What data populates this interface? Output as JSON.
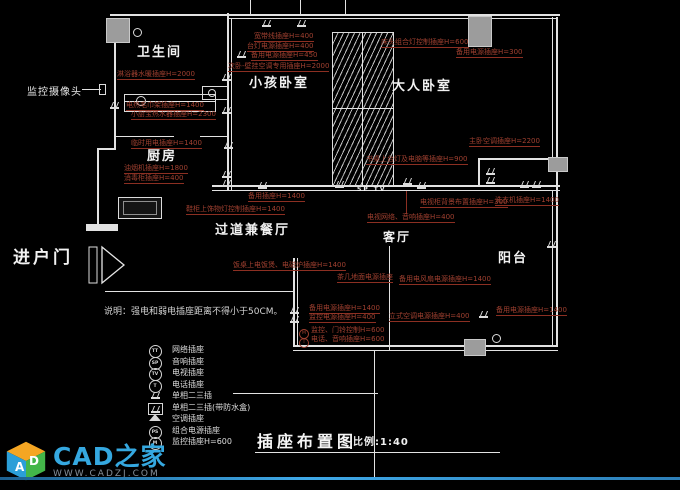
{
  "colors": {
    "background": "#000000",
    "wall": "#e2e2e2",
    "annotation": "#a04030",
    "column_fill": "#9c9c9c",
    "logo_blue": "#35a8e0",
    "footer_line": "#2d7fb8"
  },
  "rooms": [
    {
      "label": "卫生间",
      "x": 137,
      "y": 46,
      "fs": 13
    },
    {
      "label": "厨房",
      "x": 147,
      "y": 150,
      "fs": 13
    },
    {
      "label": "小孩卧室",
      "x": 249,
      "y": 77,
      "fs": 13
    },
    {
      "label": "大人卧室",
      "x": 392,
      "y": 80,
      "fs": 13
    },
    {
      "label": "过道兼餐厅",
      "x": 215,
      "y": 224,
      "fs": 13
    },
    {
      "label": "客厅",
      "x": 383,
      "y": 231,
      "fs": 12
    },
    {
      "label": "阳台",
      "x": 498,
      "y": 252,
      "fs": 13
    },
    {
      "label": "SP TV",
      "x": 357,
      "y": 187,
      "fs": 6
    }
  ],
  "entry_label": "进户门",
  "camera_label": "监控摄像头",
  "note": "说明：强电和弱电插座距离不得小于50CM。",
  "annotations": [
    {
      "text": "淋浴器水暖插座H=2000",
      "x": 117,
      "y": 71,
      "u": true
    },
    {
      "text": "电热毛巾架插座H=1400",
      "x": 126,
      "y": 102,
      "u": true
    },
    {
      "text": "小厨宝热水器插座H=2300",
      "x": 131,
      "y": 111,
      "u": true
    },
    {
      "text": "临时用电插座H=1400",
      "x": 131,
      "y": 140,
      "u": true
    },
    {
      "text": "宽带线插座H=400",
      "x": 254,
      "y": 33,
      "u": true
    },
    {
      "text": "台灯电源插座H=400",
      "x": 247,
      "y": 43,
      "u": true
    },
    {
      "text": "备用电源插座H=450",
      "x": 251,
      "y": 52,
      "u": true
    },
    {
      "text": "次卧-壁挂空调专用插座H=2000",
      "x": 228,
      "y": 63,
      "u": true
    },
    {
      "text": "床头组合灯控制插座H=600",
      "x": 381,
      "y": 39,
      "u": true
    },
    {
      "text": "备用电源插座H=300",
      "x": 456,
      "y": 49,
      "u": true
    },
    {
      "text": "主卧空调插座H=2200",
      "x": 469,
      "y": 138,
      "u": true
    },
    {
      "text": "油烟机插座H=1800",
      "x": 124,
      "y": 165,
      "u": true
    },
    {
      "text": "消毒柜插座H=400",
      "x": 124,
      "y": 175,
      "u": true
    },
    {
      "text": "鞋柜上饰物灯控制插座H=1400",
      "x": 186,
      "y": 206,
      "u": true
    },
    {
      "text": "书桌上台灯及电脑等插座H=900",
      "x": 366,
      "y": 156,
      "u": true
    },
    {
      "text": "备用插座H=1400",
      "x": 248,
      "y": 193,
      "u": true
    },
    {
      "text": "电视柜背景布置插座H=300",
      "x": 420,
      "y": 199,
      "u": true
    },
    {
      "text": "洗衣机插座H=1400",
      "x": 495,
      "y": 197,
      "u": true
    },
    {
      "text": "电视网络、音响插座H=400",
      "x": 367,
      "y": 214,
      "u": true
    },
    {
      "text": "饭桌上电饭煲、电磁炉插座H=1400",
      "x": 233,
      "y": 262,
      "u": true
    },
    {
      "text": "茶几地面电源插座",
      "x": 337,
      "y": 274,
      "u": true
    },
    {
      "text": "备用电风扇电源插座H=1400",
      "x": 399,
      "y": 276,
      "u": true
    },
    {
      "text": "备用电源插座H=1400",
      "x": 309,
      "y": 305,
      "u": true
    },
    {
      "text": "监控电源插座H=400",
      "x": 309,
      "y": 314,
      "u": true
    },
    {
      "text": "立式空调电源插座H=400",
      "x": 389,
      "y": 313,
      "u": true
    },
    {
      "text": "备用电源插座H=1400",
      "x": 496,
      "y": 307,
      "u": true
    },
    {
      "text": "监控、门铃控制H=600",
      "x": 299,
      "y": 327,
      "u": false,
      "p": "M"
    },
    {
      "text": "电话、音响插座H=600",
      "x": 299,
      "y": 336,
      "u": false,
      "p": "T"
    }
  ],
  "legend": {
    "items": [
      {
        "symbol": "circle",
        "glyph": "TT",
        "label": "网络插座"
      },
      {
        "symbol": "circle",
        "glyph": "SP",
        "label": "音响插座"
      },
      {
        "symbol": "circle",
        "glyph": "TV",
        "label": "电视插座"
      },
      {
        "symbol": "circle",
        "glyph": "T",
        "label": "电话插座"
      },
      {
        "symbol": "socket",
        "glyph": "",
        "label": "单相二三插"
      },
      {
        "symbol": "socket-box",
        "glyph": "",
        "label": "单相二三插(带防水盒)"
      },
      {
        "symbol": "socket-ac",
        "glyph": "",
        "label": "空调插座"
      },
      {
        "symbol": "circle",
        "glyph": "PS",
        "label": "组合电源插座"
      },
      {
        "symbol": "circle",
        "glyph": "M",
        "label": "监控插座H=600"
      }
    ]
  },
  "title": {
    "text": "插座布置图",
    "scale": "比例:1:40"
  },
  "logo": {
    "brand": "CAD之家",
    "site": "WWW.CADZJ.COM",
    "cube_letters": [
      "A",
      "D"
    ]
  },
  "socket_points": [
    [
      258,
      181
    ],
    [
      335,
      180
    ],
    [
      403,
      177
    ],
    [
      520,
      180
    ],
    [
      532,
      180
    ],
    [
      262,
      19
    ],
    [
      297,
      19
    ],
    [
      237,
      50
    ],
    [
      486,
      167
    ],
    [
      486,
      176
    ],
    [
      222,
      73
    ],
    [
      222,
      106
    ],
    [
      224,
      141
    ],
    [
      222,
      170
    ],
    [
      222,
      179
    ],
    [
      110,
      101
    ],
    [
      290,
      306
    ],
    [
      290,
      315
    ],
    [
      479,
      310
    ],
    [
      547,
      240
    ],
    [
      417,
      181
    ]
  ]
}
